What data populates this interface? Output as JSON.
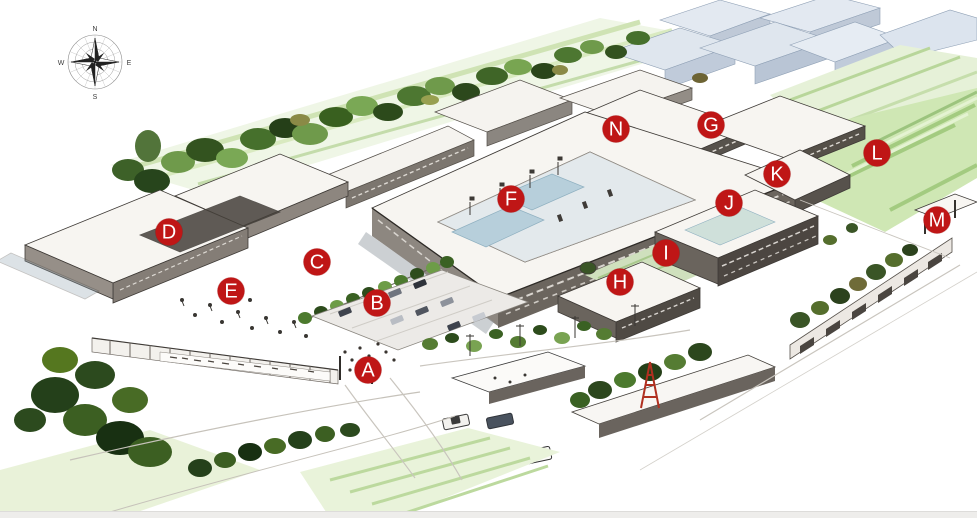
{
  "canvas": {
    "width": 977,
    "height": 518,
    "background": "#ffffff"
  },
  "colors": {
    "marker_bg": "#bf1616",
    "marker_text": "#ffffff",
    "tower_red": "#b03020",
    "foliage_dark": "#2d4c1c",
    "foliage_mid": "#4c7a2e",
    "foliage_light": "#7aa855",
    "field_green": "#cfe7b4",
    "glass_blue": "#b7cfdb",
    "facade_dark": "#6b655e",
    "page_edge": "#eeedeb"
  },
  "compass": {
    "icon": "compass-rose",
    "north": "N",
    "east": "E",
    "south": "S",
    "west": "W"
  },
  "markers": [
    {
      "id": "a",
      "label": "A",
      "x": 368,
      "y": 370
    },
    {
      "id": "b",
      "label": "B",
      "x": 377,
      "y": 303
    },
    {
      "id": "c",
      "label": "C",
      "x": 317,
      "y": 262
    },
    {
      "id": "d",
      "label": "D",
      "x": 169,
      "y": 232
    },
    {
      "id": "e",
      "label": "E",
      "x": 231,
      "y": 291
    },
    {
      "id": "f",
      "label": "F",
      "x": 511,
      "y": 199
    },
    {
      "id": "g",
      "label": "G",
      "x": 711,
      "y": 125
    },
    {
      "id": "h",
      "label": "H",
      "x": 620,
      "y": 282
    },
    {
      "id": "i",
      "label": "I",
      "x": 666,
      "y": 253
    },
    {
      "id": "j",
      "label": "J",
      "x": 729,
      "y": 203
    },
    {
      "id": "k",
      "label": "K",
      "x": 777,
      "y": 174
    },
    {
      "id": "l",
      "label": "L",
      "x": 877,
      "y": 153
    },
    {
      "id": "m",
      "label": "M",
      "x": 937,
      "y": 220
    },
    {
      "id": "n",
      "label": "N",
      "x": 616,
      "y": 129
    }
  ]
}
